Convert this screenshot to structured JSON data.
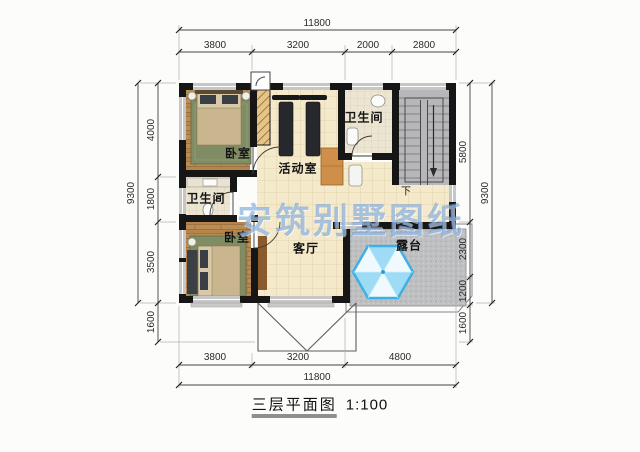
{
  "meta": {
    "caption": "三层平面图",
    "scale": "1:100",
    "watermark": "安筑别墅图纸"
  },
  "rooms": {
    "bedroom_top": "卧室",
    "bedroom_bottom": "卧室",
    "bathroom_top": "卫生间",
    "bathroom_mid": "卫生间",
    "activity": "活动室",
    "living": "客厅",
    "terrace": "露台",
    "stair_down": "下"
  },
  "dimensions": {
    "top": {
      "total": "11800",
      "segments": [
        "3800",
        "3200",
        "2000",
        "2800"
      ]
    },
    "bottom": {
      "total": "11800",
      "segments": [
        "3800",
        "3200",
        "4800"
      ]
    },
    "left": {
      "total": "9300",
      "segments": [
        "4000",
        "1800",
        "3500"
      ],
      "below": "1600"
    },
    "right": {
      "total": "9300",
      "segments": [
        "5800",
        "2300",
        "1200",
        "1600"
      ]
    }
  },
  "colors": {
    "wall": "#161616",
    "tile_floor": "#f4e9ca",
    "bath_floor": "#ece5d2",
    "wood_floor": "#b5854c",
    "stair": "#b7b7b9",
    "terrace": "#bfc0c2",
    "parasol_blue": "#3fb0e4",
    "watermark_blue": "#6c9cd7"
  }
}
